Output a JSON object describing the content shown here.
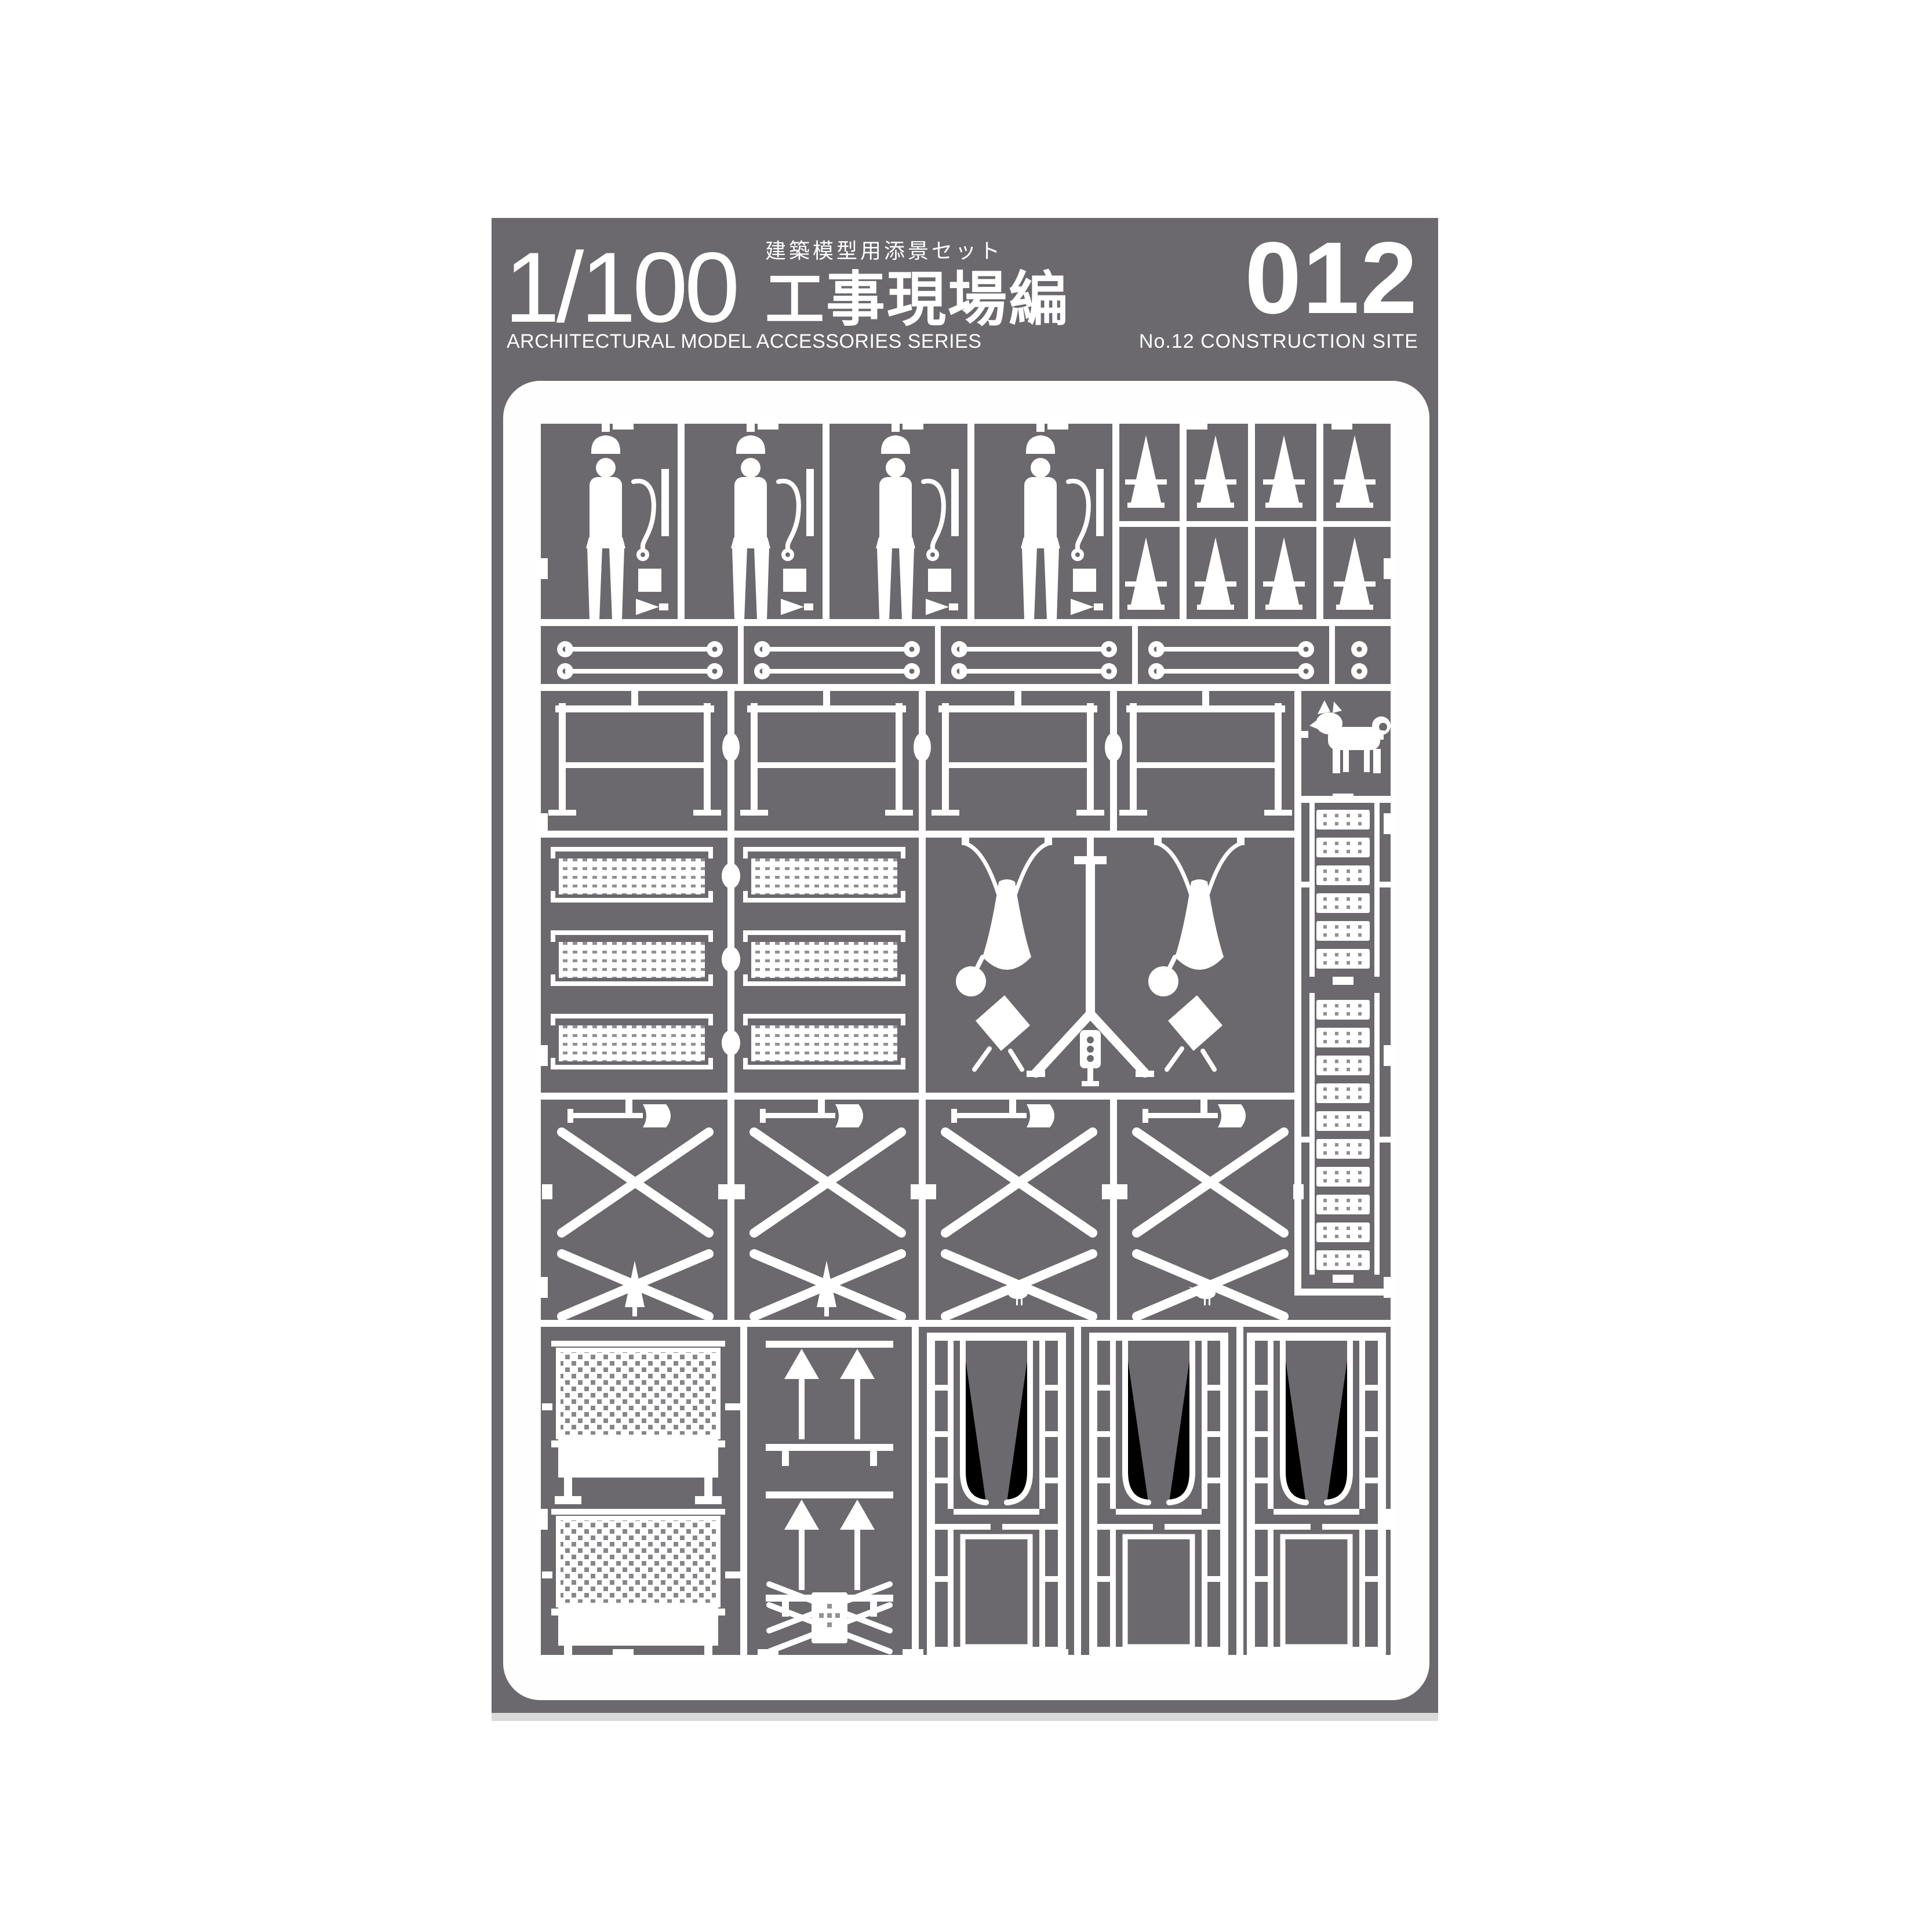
{
  "header": {
    "scale": "1/100",
    "series_jp_small": "建築模型用添景セット",
    "series_jp_large": "工事現場編",
    "series_en": "ARCHITECTURAL MODEL ACCESSORIES SERIES",
    "number": "012",
    "subtitle_en": "No.12 CONSTRUCTION SITE"
  },
  "colors": {
    "card_gray": "#6b696d",
    "panel_white": "#fefefe",
    "part_white": "#ffffff",
    "perforation_gray": "#919094",
    "shadow_gray": "#dadada"
  },
  "sprue": {
    "description": "laser-cut white parts sheet for 1/100 construction site scene",
    "parts": [
      {
        "icon": "worker-figure-icon",
        "count": 4
      },
      {
        "icon": "safety-helmet-icon",
        "count": 4
      },
      {
        "icon": "safety-rope-icon",
        "count": 4
      },
      {
        "icon": "traffic-cone-icon",
        "count": 8
      },
      {
        "icon": "scaffold-pipe-icon",
        "count": 8
      },
      {
        "icon": "barricade-fence-icon",
        "count": 4
      },
      {
        "icon": "dog-icon",
        "count": 1
      },
      {
        "icon": "perforated-scaffold-board-icon",
        "count": 6
      },
      {
        "icon": "work-floodlight-icon",
        "count": 2
      },
      {
        "icon": "traffic-signal-icon",
        "count": 1
      },
      {
        "icon": "vertical-ladder-icon",
        "count": 2
      },
      {
        "icon": "scaffold-xframe-icon",
        "count": 4
      },
      {
        "icon": "shovel-icon",
        "count": 4
      },
      {
        "icon": "tree-icon",
        "count": 2
      },
      {
        "icon": "bird-icon",
        "count": 2
      },
      {
        "icon": "mesh-fence-panel-icon",
        "count": 2
      },
      {
        "icon": "arrow-sign-icon",
        "count": 2
      },
      {
        "icon": "cross-barrier-icon",
        "count": 1
      },
      {
        "icon": "site-gate-icon",
        "count": 3
      }
    ]
  }
}
